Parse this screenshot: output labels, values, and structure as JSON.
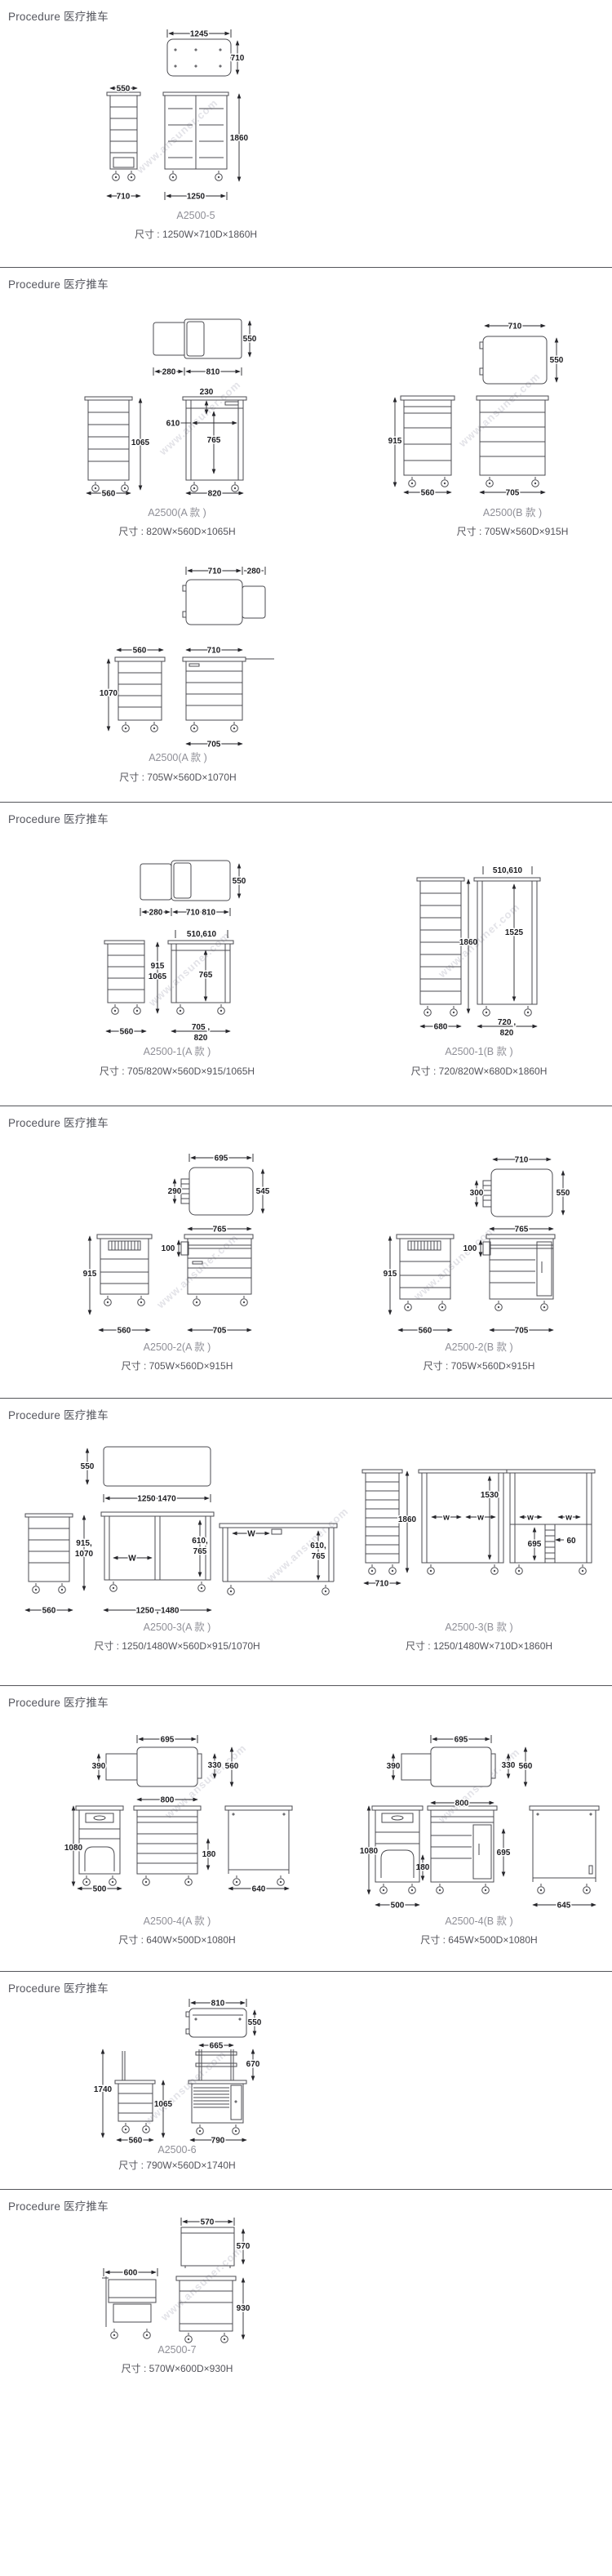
{
  "page": {
    "watermark": "www.ansuner.com"
  },
  "sections": [
    {
      "header": "Procedure 医疗推车",
      "products": [
        {
          "model": "A2500-5",
          "size": "尺寸 : 1250W×710D×1860H",
          "dims": {
            "top_width": "1245",
            "top_depth": "710",
            "side_width": "550",
            "side_bottom_width": "710",
            "height": "1860",
            "front_bottom_width": "1250"
          }
        }
      ]
    },
    {
      "header": "Procedure 医疗推车",
      "products": [
        {
          "model": "A2500(A 款 )",
          "size": "尺寸 : 820W×560D×1065H",
          "dims": {
            "top_left_width": "280",
            "top_right_width": "810",
            "top_depth": "550",
            "tray_depth": "230",
            "inner_width": "610",
            "inner_height": "765",
            "height": "1065",
            "side_bottom_width": "560",
            "front_bottom_width": "820"
          }
        },
        {
          "model": "A2500(B 款 )",
          "size": "尺寸 : 705W×560D×915H",
          "dims": {
            "top_width": "710",
            "top_depth": "550",
            "height": "915",
            "side_bottom_width": "560",
            "front_bottom_width": "705"
          }
        },
        {
          "model": "A2500(A 款 )",
          "size": "尺寸 : 705W×560D×1070H",
          "dims": {
            "top_width": "710",
            "top_right_width": "280",
            "side_top_width": "560",
            "front_top_width": "710",
            "height": "1070",
            "front_bottom_width": "705"
          }
        }
      ]
    },
    {
      "header": "Procedure 医疗推车",
      "products": [
        {
          "model": "A2500-1(A 款 )",
          "size": "尺寸 : 705/820W×560D×915/1065H",
          "dims": {
            "top_left_width": "280",
            "top_width": "710 810",
            "top_depth": "550",
            "column_width": "510,610",
            "height_1": "915",
            "height_2": "1065",
            "inner_height": "765",
            "side_bottom_width": "560",
            "front_bottom_1": "705 ,",
            "front_bottom_2": "820"
          }
        },
        {
          "model": "A2500-1(B 款 )",
          "size": "尺寸 : 720/820W×680D×1860H",
          "dims": {
            "column_width": "510,610",
            "height": "1860",
            "inner_height": "1525",
            "side_bottom_width": "680",
            "front_bottom_1": "720 ,",
            "front_bottom_2": "820"
          }
        }
      ]
    },
    {
      "header": "Procedure 医疗推车",
      "products": [
        {
          "model": "A2500-2(A 款 )",
          "size": "尺寸 : 705W×560D×915H",
          "dims": {
            "top_width": "695",
            "top_depth": "545",
            "handle_height": "290",
            "front_top_width": "765",
            "handle_depth": "100",
            "height": "915",
            "side_bottom_width": "560",
            "front_bottom_width": "705"
          }
        },
        {
          "model": "A2500-2(B 款 )",
          "size": "尺寸 : 705W×560D×915H",
          "dims": {
            "top_width": "710",
            "top_depth": "550",
            "handle_height": "300",
            "front_top_width": "765",
            "handle_depth": "100",
            "height": "915",
            "side_bottom_width": "560",
            "front_bottom_width": "705"
          }
        }
      ]
    },
    {
      "header": "Procedure 医疗推车",
      "products": [
        {
          "model": "A2500-3(A 款 )",
          "size": "尺寸 : 1250/1480W×560D×915/1070H",
          "dims": {
            "top_depth": "550",
            "top_width": "1250 1470",
            "height_1": "915,",
            "height_2": "1070",
            "w_label": "W",
            "inner_1": "610,",
            "inner_2": "765",
            "side_bottom_width": "560",
            "front_bottom_width": "1250 , 1480"
          }
        },
        {
          "model": "A2500-3(B 款 )",
          "size": "尺寸 : 1250/1480W×710D×1860H",
          "dims": {
            "height": "1860",
            "side_bottom_width": "710",
            "inner_height": "1530",
            "w_label": "w",
            "shelf_height": "695",
            "post_width": "60"
          }
        }
      ]
    },
    {
      "header": "Procedure 医疗推车",
      "products": [
        {
          "model": "A2500-4(A 款 )",
          "size": "尺寸 : 640W×500D×1080H",
          "dims": {
            "top_width": "695",
            "top_left_depth": "390",
            "top_depth_1": "330",
            "top_depth_2": "560",
            "front_top_width": "800",
            "height": "1080",
            "bin_height": "180",
            "side_bottom_width": "500",
            "right_bottom_width": "640"
          }
        },
        {
          "model": "A2500-4(B 款 )",
          "size": "尺寸 : 645W×500D×1080H",
          "dims": {
            "top_width": "695",
            "top_left_depth": "390",
            "top_depth_1": "330",
            "top_depth_2": "560",
            "front_top_width": "800",
            "height": "1080",
            "bin_height": "180",
            "door_height": "695",
            "side_bottom_width": "500",
            "right_bottom_width": "645"
          }
        }
      ]
    },
    {
      "header": "Procedure 医疗推车",
      "products": [
        {
          "model": "A2500-6",
          "size": "尺寸 : 790W×560D×1740H",
          "dims": {
            "top_width": "810",
            "top_depth": "550",
            "upper_width": "665",
            "upper_height": "670",
            "height": "1740",
            "body_height": "1065",
            "side_bottom_width": "560",
            "front_bottom_width": "790"
          }
        }
      ]
    },
    {
      "header": "Procedure 医疗推车",
      "products": [
        {
          "model": "A2500-7",
          "size": "尺寸 : 570W×600D×930H",
          "dims": {
            "top_width": "570",
            "top_depth": "570",
            "side_width": "600",
            "height": "930"
          }
        }
      ]
    }
  ]
}
